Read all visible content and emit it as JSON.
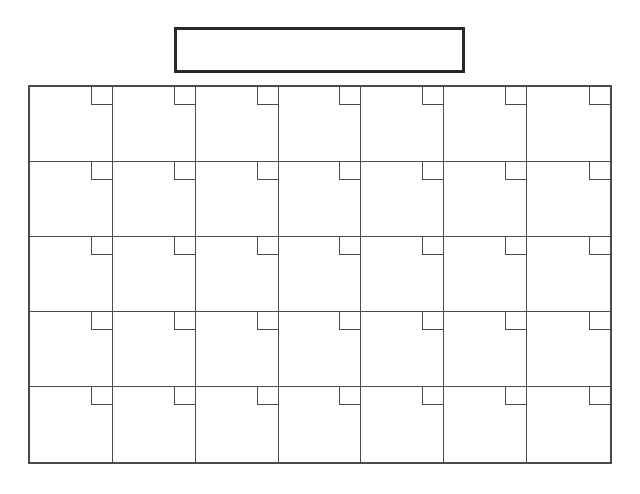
{
  "page": {
    "type": "blank-calendar-template",
    "background": "#ffffff"
  },
  "title_box": {
    "value": "",
    "border_color": "#28282b"
  },
  "calendar": {
    "rows": 5,
    "columns": 7,
    "line_color": "#4a4a4a",
    "cell_fill": "#ffffff",
    "dates": [
      [
        "",
        "",
        "",
        "",
        "",
        "",
        ""
      ],
      [
        "",
        "",
        "",
        "",
        "",
        "",
        ""
      ],
      [
        "",
        "",
        "",
        "",
        "",
        "",
        ""
      ],
      [
        "",
        "",
        "",
        "",
        "",
        "",
        ""
      ],
      [
        "",
        "",
        "",
        "",
        "",
        "",
        ""
      ]
    ]
  }
}
